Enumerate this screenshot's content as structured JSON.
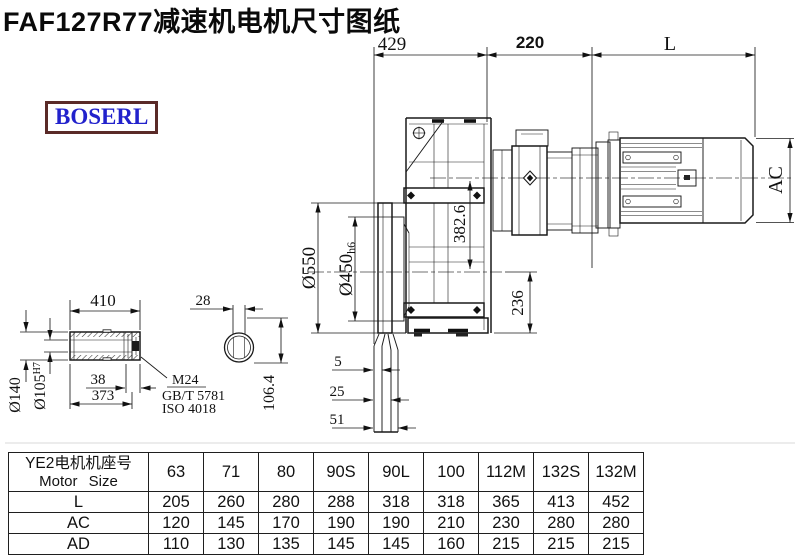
{
  "title": "FAF127R77减速机电机尺寸图纸",
  "brand": "BOSERL",
  "colors": {
    "brand_text": "#2222cc",
    "brand_border": "#5a2a28",
    "line": "#1a1a1a"
  },
  "drawing": {
    "dim_429": "429",
    "dim_220": "220",
    "dim_L": "L",
    "dim_AC": "AC",
    "dia_550": "Ø550",
    "dia_450": "Ø450",
    "dia_450_tol": "h6",
    "dim_382_6": "382.6",
    "dim_236": "236",
    "dim_5": "5",
    "dim_25": "25",
    "dim_51": "51",
    "dim_410": "410",
    "dim_28": "28",
    "dim_38": "38",
    "dim_373": "373",
    "dia_140": "Ø140",
    "dia_105": "Ø105",
    "dia_105_tol": "H7",
    "dim_106_4": "106.4",
    "thread_label": "M24",
    "thread_std1": "GB/T 5781",
    "thread_std2": "ISO 4018"
  },
  "table": {
    "header_cn": "YE2电机机座号",
    "header_en": "Motor Size",
    "columns": [
      "63",
      "71",
      "80",
      "90S",
      "90L",
      "100",
      "112M",
      "132S",
      "132M"
    ],
    "rows": [
      {
        "label": "L",
        "values": [
          "205",
          "260",
          "280",
          "288",
          "318",
          "318",
          "365",
          "413",
          "452"
        ]
      },
      {
        "label": "AC",
        "values": [
          "120",
          "145",
          "170",
          "190",
          "190",
          "210",
          "230",
          "280",
          "280"
        ]
      },
      {
        "label": "AD",
        "values": [
          "110",
          "130",
          "135",
          "145",
          "145",
          "160",
          "215",
          "215",
          "215"
        ]
      }
    ]
  }
}
